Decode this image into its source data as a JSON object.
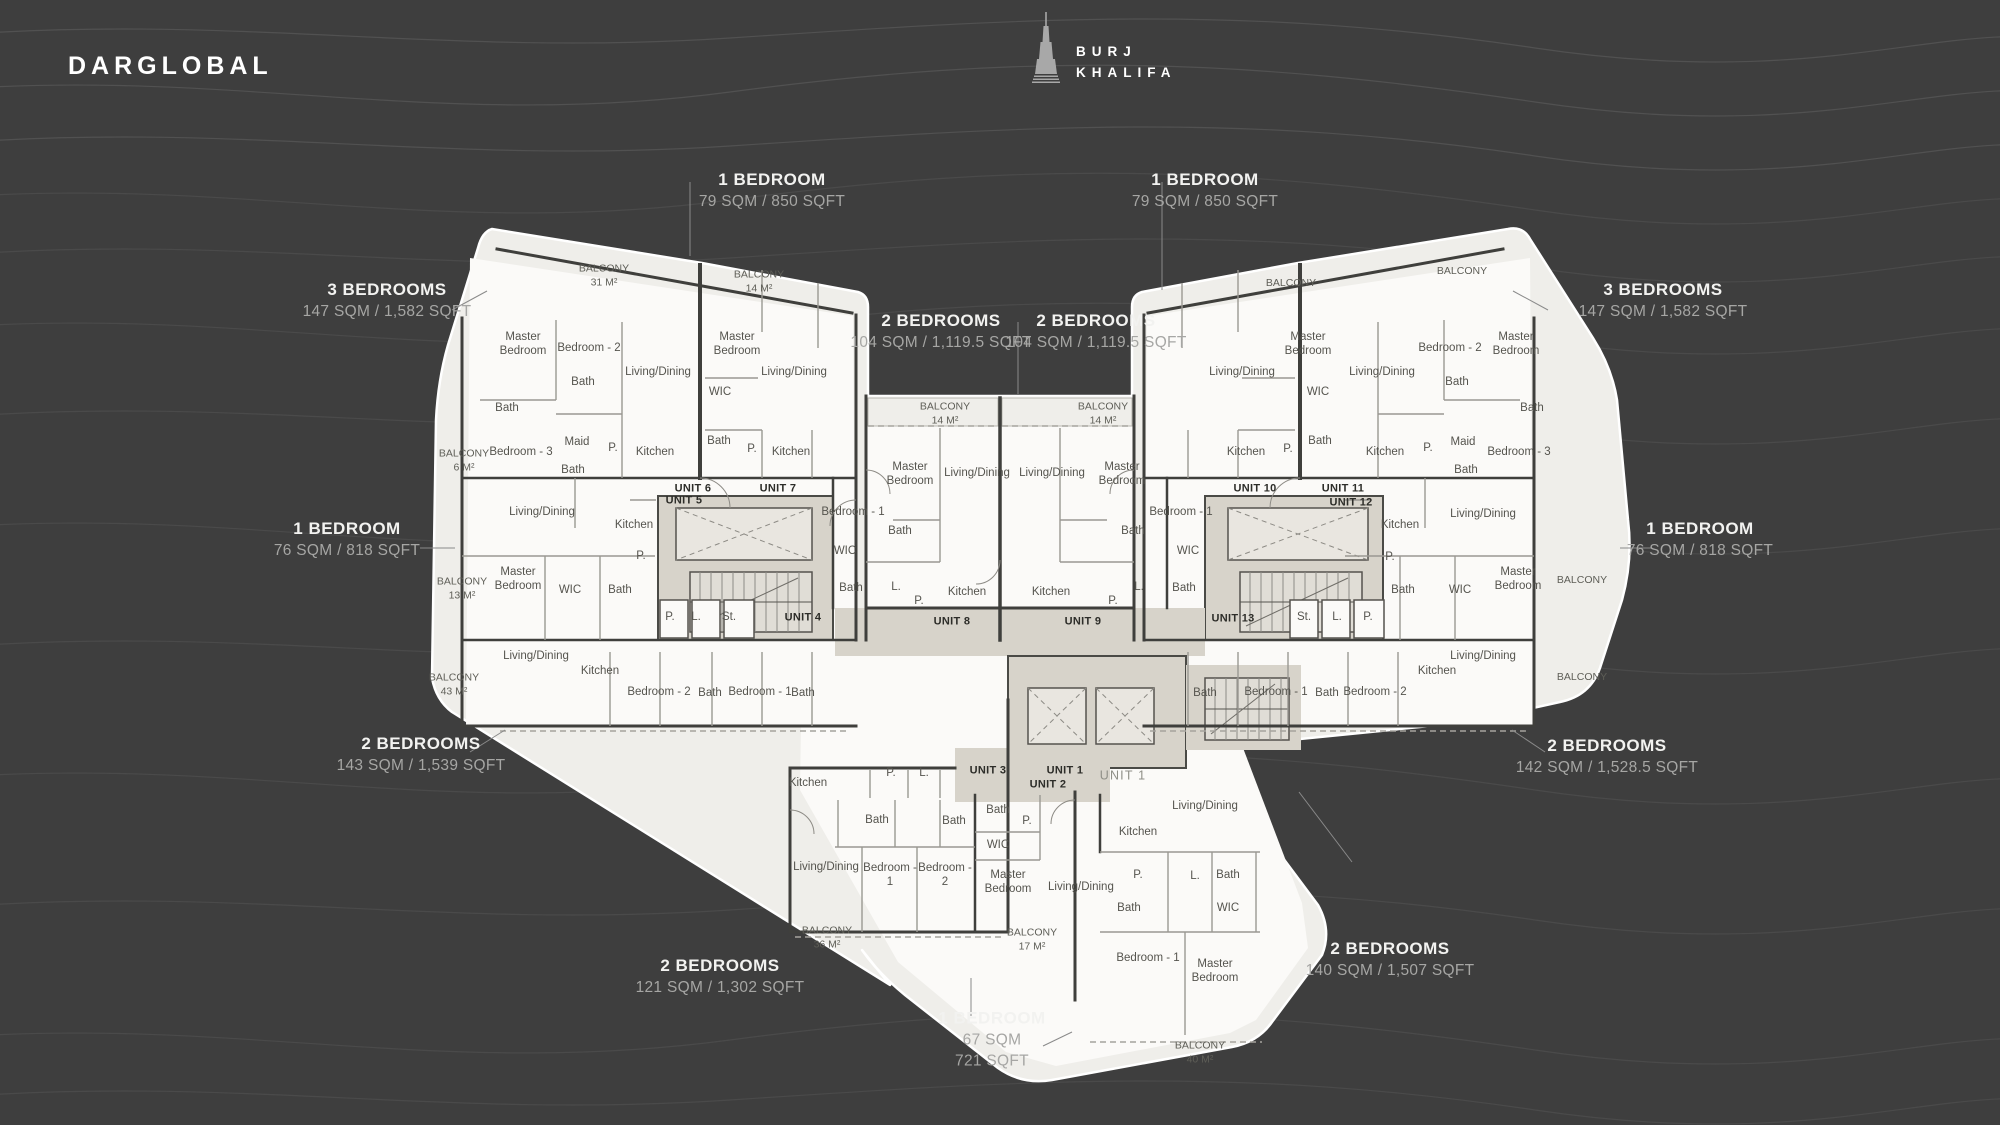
{
  "brand": {
    "logo": "DARGLOBAL"
  },
  "landmark": {
    "name_line1": "BURJ",
    "name_line2": "KHALIFA",
    "icon": "burj-khalifa-tower-icon"
  },
  "location_label": "DUBAI CANAL",
  "colors": {
    "background": "#3e3e3e",
    "plan_terrace": "#efeeea",
    "unit_fill": "#fbfaf8",
    "core_fill": "#d7d3ca",
    "wall": "#3f3f3c",
    "callout_title": "#f2f2f0",
    "callout_area": "#a6a6a4",
    "room_text": "#55544e"
  },
  "callouts": [
    {
      "title": "1 BEDROOM",
      "area": "79 SQM / 850 SQFT",
      "x": 772,
      "y": 191
    },
    {
      "title": "1 BEDROOM",
      "area": "79 SQM / 850 SQFT",
      "x": 1205,
      "y": 191
    },
    {
      "title": "3 BEDROOMS",
      "area": "147 SQM / 1,582 SQFT",
      "x": 387,
      "y": 301
    },
    {
      "title": "3 BEDROOMS",
      "area": "147 SQM / 1,582 SQFT",
      "x": 1663,
      "y": 301
    },
    {
      "title": "2 BEDROOMS",
      "area": "104 SQM / 1,119.5 SQFT",
      "x": 941,
      "y": 332
    },
    {
      "title": "2 BEDROOMS",
      "area": "104 SQM / 1,119.5 SQFT",
      "x": 1096,
      "y": 332
    },
    {
      "title": "1 BEDROOM",
      "area": "76 SQM / 818 SQFT",
      "x": 347,
      "y": 540
    },
    {
      "title": "1 BEDROOM",
      "area": "76 SQM / 818 SQFT",
      "x": 1700,
      "y": 540
    },
    {
      "title": "2 BEDROOMS",
      "area": "143 SQM / 1,539 SQFT",
      "x": 421,
      "y": 755
    },
    {
      "title": "2 BEDROOMS",
      "area": "142 SQM / 1,528.5 SQFT",
      "x": 1607,
      "y": 757
    },
    {
      "title": "2 BEDROOMS",
      "area": "121 SQM / 1,302 SQFT",
      "x": 720,
      "y": 977
    },
    {
      "title": "2 BEDROOMS",
      "area": "140 SQM / 1,507 SQFT",
      "x": 1390,
      "y": 960
    },
    {
      "title": "1 BEDROOM",
      "area": "67 SQM",
      "area2": "721 SQFT",
      "x": 992,
      "y": 1040
    }
  ],
  "balcony_labels": [
    {
      "name": "BALCONY",
      "size": "31 M²",
      "x": 604,
      "y": 276
    },
    {
      "name": "BALCONY",
      "size": "14 M²",
      "x": 759,
      "y": 282
    },
    {
      "name": "BALCONY",
      "size": "",
      "x": 1291,
      "y": 284
    },
    {
      "name": "BALCONY",
      "size": "",
      "x": 1462,
      "y": 272
    },
    {
      "name": "BALCONY",
      "size": "6 M²",
      "x": 464,
      "y": 461
    },
    {
      "name": "BALCONY",
      "size": "13 M²",
      "x": 462,
      "y": 589
    },
    {
      "name": "BALCONY",
      "size": "43 M²",
      "x": 454,
      "y": 685
    },
    {
      "name": "BALCONY",
      "size": "",
      "x": 1582,
      "y": 581
    },
    {
      "name": "BALCONY",
      "size": "",
      "x": 1582,
      "y": 678
    },
    {
      "name": "BALCONY",
      "size": "14 M²",
      "x": 945,
      "y": 414
    },
    {
      "name": "BALCONY",
      "size": "14 M²",
      "x": 1103,
      "y": 414
    },
    {
      "name": "BALCONY",
      "size": "36 M²",
      "x": 827,
      "y": 938
    },
    {
      "name": "BALCONY",
      "size": "17 M²",
      "x": 1032,
      "y": 940
    },
    {
      "name": "BALCONY",
      "size": "40 M²",
      "x": 1200,
      "y": 1053
    }
  ],
  "unit_tags": [
    {
      "label": "UNIT 6",
      "x": 693,
      "y": 489
    },
    {
      "label": "UNIT 7",
      "x": 778,
      "y": 489
    },
    {
      "label": "UNIT 5",
      "x": 684,
      "y": 501
    },
    {
      "label": "UNIT 4",
      "x": 803,
      "y": 618
    },
    {
      "label": "UNIT 8",
      "x": 952,
      "y": 622
    },
    {
      "label": "UNIT 9",
      "x": 1083,
      "y": 622
    },
    {
      "label": "UNIT 13",
      "x": 1233,
      "y": 619
    },
    {
      "label": "UNIT 10",
      "x": 1255,
      "y": 489
    },
    {
      "label": "UNIT 11",
      "x": 1343,
      "y": 489
    },
    {
      "label": "UNIT 12",
      "x": 1351,
      "y": 503
    },
    {
      "label": "UNIT 3",
      "x": 988,
      "y": 771
    },
    {
      "label": "UNIT 1",
      "x": 1065,
      "y": 771
    },
    {
      "label": "UNIT 2",
      "x": 1048,
      "y": 785
    },
    {
      "label": "UNIT 1",
      "x": 1123,
      "y": 776,
      "light": true
    }
  ],
  "room_labels": [
    {
      "t": "Master Bedroom",
      "x": 523,
      "y": 344,
      "w": 62
    },
    {
      "t": "Bedroom - 2",
      "x": 589,
      "y": 348
    },
    {
      "t": "Bath",
      "x": 583,
      "y": 382
    },
    {
      "t": "Living/Dining",
      "x": 658,
      "y": 372
    },
    {
      "t": "Bath",
      "x": 507,
      "y": 408
    },
    {
      "t": "Bedroom - 3",
      "x": 521,
      "y": 452
    },
    {
      "t": "Maid",
      "x": 577,
      "y": 442
    },
    {
      "t": "P.",
      "x": 613,
      "y": 448
    },
    {
      "t": "Kitchen",
      "x": 655,
      "y": 452
    },
    {
      "t": "Bath",
      "x": 573,
      "y": 470
    },
    {
      "t": "Master Bedroom",
      "x": 737,
      "y": 344,
      "w": 62
    },
    {
      "t": "WIC",
      "x": 720,
      "y": 392
    },
    {
      "t": "Living/Dining",
      "x": 794,
      "y": 372
    },
    {
      "t": "Bath",
      "x": 719,
      "y": 441
    },
    {
      "t": "P.",
      "x": 752,
      "y": 449
    },
    {
      "t": "Kitchen",
      "x": 791,
      "y": 452
    },
    {
      "t": "Living/Dining",
      "x": 542,
      "y": 512
    },
    {
      "t": "Kitchen",
      "x": 634,
      "y": 525
    },
    {
      "t": "P.",
      "x": 641,
      "y": 556
    },
    {
      "t": "Master Bedroom",
      "x": 518,
      "y": 579,
      "w": 62
    },
    {
      "t": "WIC",
      "x": 570,
      "y": 590
    },
    {
      "t": "Bath",
      "x": 620,
      "y": 590
    },
    {
      "t": "P.",
      "x": 670,
      "y": 617
    },
    {
      "t": "L.",
      "x": 696,
      "y": 617
    },
    {
      "t": "St.",
      "x": 729,
      "y": 617
    },
    {
      "t": "Living/Dining",
      "x": 536,
      "y": 656
    },
    {
      "t": "Kitchen",
      "x": 600,
      "y": 671
    },
    {
      "t": "Bedroom - 2",
      "x": 659,
      "y": 692
    },
    {
      "t": "Bath",
      "x": 710,
      "y": 693
    },
    {
      "t": "Bedroom - 1",
      "x": 760,
      "y": 692
    },
    {
      "t": "Bath",
      "x": 803,
      "y": 693
    },
    {
      "t": "Master Bedroom",
      "x": 910,
      "y": 474,
      "w": 62
    },
    {
      "t": "Living/Dining",
      "x": 977,
      "y": 473
    },
    {
      "t": "Living/Dining",
      "x": 1052,
      "y": 473
    },
    {
      "t": "Master Bedroom",
      "x": 1122,
      "y": 474,
      "w": 62
    },
    {
      "t": "Bedroom - 1",
      "x": 853,
      "y": 512
    },
    {
      "t": "Bath",
      "x": 900,
      "y": 531
    },
    {
      "t": "WIC",
      "x": 845,
      "y": 551
    },
    {
      "t": "Bath",
      "x": 851,
      "y": 588
    },
    {
      "t": "L.",
      "x": 896,
      "y": 587
    },
    {
      "t": "P.",
      "x": 919,
      "y": 601
    },
    {
      "t": "Kitchen",
      "x": 967,
      "y": 592
    },
    {
      "t": "Kitchen",
      "x": 1051,
      "y": 592
    },
    {
      "t": "P.",
      "x": 1113,
      "y": 601
    },
    {
      "t": "L.",
      "x": 1139,
      "y": 587
    },
    {
      "t": "Bath",
      "x": 1133,
      "y": 531
    },
    {
      "t": "Bedroom - 1",
      "x": 1181,
      "y": 512
    },
    {
      "t": "WIC",
      "x": 1188,
      "y": 551
    },
    {
      "t": "Bath",
      "x": 1184,
      "y": 588
    },
    {
      "t": "Living/Dining",
      "x": 1242,
      "y": 372
    },
    {
      "t": "Master Bedroom",
      "x": 1308,
      "y": 344,
      "w": 62
    },
    {
      "t": "WIC",
      "x": 1318,
      "y": 392
    },
    {
      "t": "Bath",
      "x": 1320,
      "y": 441
    },
    {
      "t": "P.",
      "x": 1288,
      "y": 449
    },
    {
      "t": "Kitchen",
      "x": 1246,
      "y": 452
    },
    {
      "t": "Bedroom - 2",
      "x": 1450,
      "y": 348
    },
    {
      "t": "Master Bedroom",
      "x": 1516,
      "y": 344,
      "w": 62
    },
    {
      "t": "Bath",
      "x": 1457,
      "y": 382
    },
    {
      "t": "Living/Dining",
      "x": 1382,
      "y": 372
    },
    {
      "t": "Bath",
      "x": 1532,
      "y": 408
    },
    {
      "t": "Bedroom - 3",
      "x": 1519,
      "y": 452
    },
    {
      "t": "Maid",
      "x": 1463,
      "y": 442
    },
    {
      "t": "P.",
      "x": 1428,
      "y": 448
    },
    {
      "t": "Kitchen",
      "x": 1385,
      "y": 452
    },
    {
      "t": "Bath",
      "x": 1466,
      "y": 470
    },
    {
      "t": "Living/Dining",
      "x": 1483,
      "y": 514
    },
    {
      "t": "Kitchen",
      "x": 1400,
      "y": 525
    },
    {
      "t": "P.",
      "x": 1390,
      "y": 557
    },
    {
      "t": "Master Bedroom",
      "x": 1518,
      "y": 579,
      "w": 62
    },
    {
      "t": "WIC",
      "x": 1460,
      "y": 590
    },
    {
      "t": "Bath",
      "x": 1403,
      "y": 590
    },
    {
      "t": "St.",
      "x": 1304,
      "y": 617
    },
    {
      "t": "L.",
      "x": 1337,
      "y": 617
    },
    {
      "t": "P.",
      "x": 1368,
      "y": 617
    },
    {
      "t": "Living/Dining",
      "x": 1483,
      "y": 656
    },
    {
      "t": "Kitchen",
      "x": 1437,
      "y": 671
    },
    {
      "t": "Bedroom - 2",
      "x": 1375,
      "y": 692
    },
    {
      "t": "Bath",
      "x": 1327,
      "y": 693
    },
    {
      "t": "Bedroom - 1",
      "x": 1276,
      "y": 692
    },
    {
      "t": "Bath",
      "x": 1205,
      "y": 693
    },
    {
      "t": "Kitchen",
      "x": 808,
      "y": 783
    },
    {
      "t": "P.",
      "x": 891,
      "y": 773
    },
    {
      "t": "L.",
      "x": 924,
      "y": 773
    },
    {
      "t": "Bath",
      "x": 877,
      "y": 820
    },
    {
      "t": "Bath",
      "x": 954,
      "y": 821
    },
    {
      "t": "Living/Dining",
      "x": 826,
      "y": 867
    },
    {
      "t": "Bedroom - 1",
      "x": 890,
      "y": 875,
      "w": 58
    },
    {
      "t": "Bedroom - 2",
      "x": 945,
      "y": 875,
      "w": 58
    },
    {
      "t": "Bath",
      "x": 998,
      "y": 810
    },
    {
      "t": "P.",
      "x": 1027,
      "y": 821
    },
    {
      "t": "WIC",
      "x": 998,
      "y": 845
    },
    {
      "t": "Master Bedroom",
      "x": 1008,
      "y": 882,
      "w": 62
    },
    {
      "t": "Living/Dining",
      "x": 1078,
      "y": 887,
      "w": 60
    },
    {
      "t": "Living/Dining",
      "x": 1205,
      "y": 806
    },
    {
      "t": "Kitchen",
      "x": 1138,
      "y": 832
    },
    {
      "t": "P.",
      "x": 1138,
      "y": 875
    },
    {
      "t": "L.",
      "x": 1195,
      "y": 876
    },
    {
      "t": "Bath",
      "x": 1228,
      "y": 875
    },
    {
      "t": "Bath",
      "x": 1129,
      "y": 908
    },
    {
      "t": "WIC",
      "x": 1228,
      "y": 908
    },
    {
      "t": "Bedroom - 1",
      "x": 1148,
      "y": 958
    },
    {
      "t": "Master Bedroom",
      "x": 1215,
      "y": 971,
      "w": 62
    }
  ]
}
